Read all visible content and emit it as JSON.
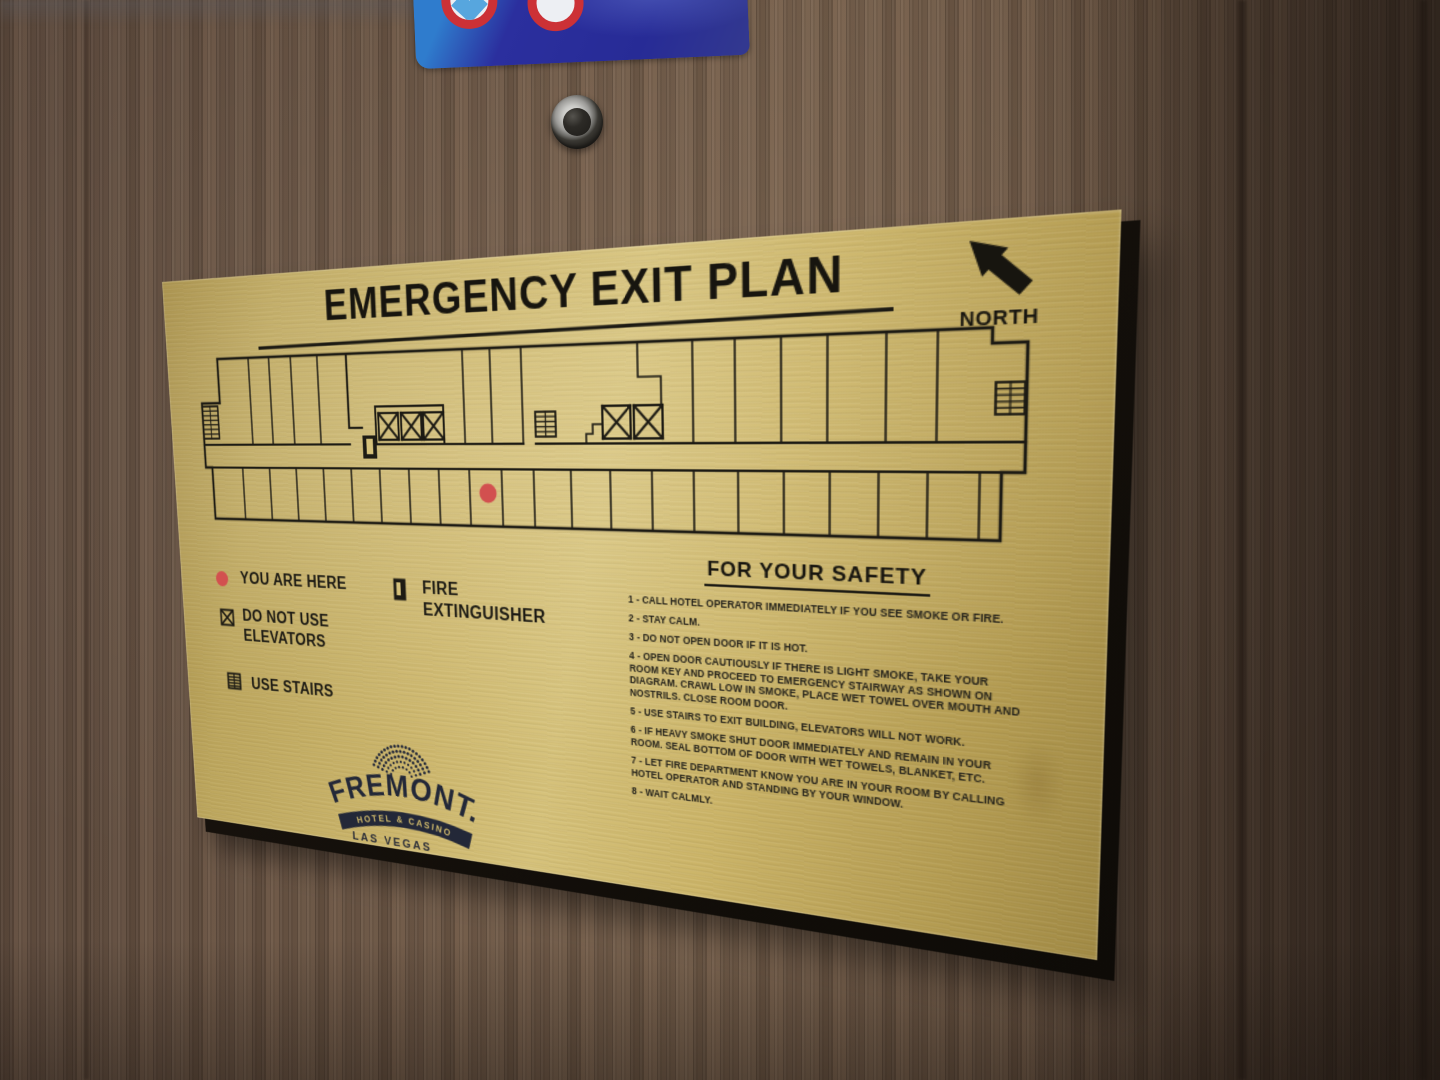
{
  "scene": {
    "sticker": {
      "color_main": "#2b2f9e",
      "color_light": "#2f7ccd",
      "ring_color": "#cc3136"
    },
    "wall_color": "#6a5648"
  },
  "plaque": {
    "title": "EMERGENCY EXIT PLAN",
    "north_label": "NORTH",
    "legend": {
      "you_are_here": "YOU ARE HERE",
      "do_not_use": [
        "DO NOT USE",
        "ELEVATORS"
      ],
      "use_stairs": "USE STAIRS",
      "fire_extinguisher": [
        "FIRE",
        "EXTINGUISHER"
      ]
    },
    "safety": {
      "heading": "FOR YOUR SAFETY",
      "items": [
        "1 - CALL HOTEL OPERATOR IMMEDIATELY IF YOU SEE SMOKE OR FIRE.",
        "2 - STAY CALM.",
        "3 - DO NOT OPEN DOOR IF IT IS HOT.",
        "4 - OPEN DOOR CAUTIOUSLY IF THERE IS LIGHT SMOKE, TAKE YOUR ROOM KEY AND PROCEED TO EMERGENCY STAIRWAY AS SHOWN ON DIAGRAM. CRAWL LOW IN SMOKE, PLACE WET TOWEL OVER MOUTH AND NOSTRILS. CLOSE ROOM DOOR.",
        "5 - USE STAIRS TO EXIT BUILDING, ELEVATORS WILL NOT WORK.",
        "6 - IF HEAVY SMOKE SHUT DOOR IMMEDIATELY AND REMAIN IN YOUR ROOM. SEAL BOTTOM OF DOOR WITH WET TOWELS, BLANKET, ETC.",
        "7 - LET FIRE DEPARTMENT KNOW YOU ARE IN YOUR ROOM BY CALLING HOTEL OPERATOR AND STANDING BY YOUR WINDOW.",
        "8 - WAIT CALMLY."
      ]
    },
    "logo": {
      "name": "FREMONT.",
      "banner": "HOTEL & CASINO",
      "city": "LAS VEGAS"
    },
    "colors": {
      "plate": "#c9b268",
      "ink": "#1d1b14",
      "you_are_here_dot": "#d2504f"
    }
  }
}
